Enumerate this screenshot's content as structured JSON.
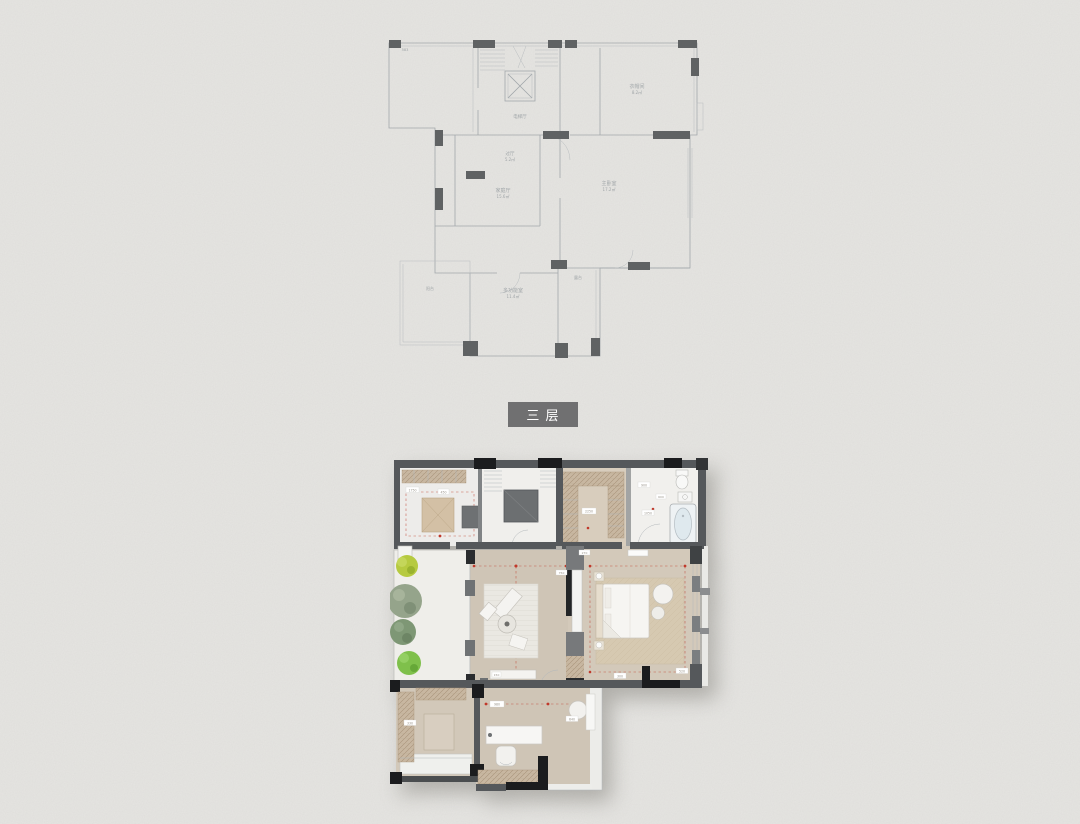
{
  "page": {
    "width": 1080,
    "height": 824,
    "background": "#e6e5e2"
  },
  "floor_badge": {
    "text": "三 层",
    "bg": "#707071",
    "color": "#ffffff"
  },
  "palette": {
    "line": "#9aa0a4",
    "wall_dark": "#4e5153",
    "wall_gray": "#55585b",
    "wall_black": "#1b1c1e",
    "floor_white": "#efeeea",
    "floor_beige": "#cfc5b6",
    "floor_beige_light": "#d8cdbd",
    "closet_tan": "#c8b7a1",
    "rug_white": "#eae8e2",
    "rug_tan": "#d6c9b1",
    "elevator_gray": "#6c6f71",
    "tree_bright": "#b6ca40",
    "tree_sage": "#95a48b",
    "tree_olive": "#7e9775",
    "tree_green": "#7fc04b",
    "accent_red": "#c0392b",
    "tub_blue": "#dfe9ee",
    "badge_bg": "#707071"
  },
  "line_plan": {
    "labels": [
      {
        "text": "583"
      },
      {
        "text": "衣帽间"
      },
      {
        "text": "8.2㎡"
      },
      {
        "text": "电梯厅"
      },
      {
        "text": "过厅"
      },
      {
        "text": "5.2㎡"
      },
      {
        "text": "家庭厅"
      },
      {
        "text": "15.6㎡"
      },
      {
        "text": "主卧室"
      },
      {
        "text": "17.2㎡"
      },
      {
        "text": "多功能室"
      },
      {
        "text": "11.4㎡"
      },
      {
        "text": "露台"
      },
      {
        "text": "阳台"
      }
    ]
  },
  "render_plan": {
    "chips": [
      {
        "text": "1750"
      },
      {
        "text": "450"
      },
      {
        "text": "2250"
      },
      {
        "text": "900"
      },
      {
        "text": "1050"
      },
      {
        "text": "600"
      },
      {
        "text": "150"
      },
      {
        "text": "750"
      },
      {
        "text": "300"
      },
      {
        "text": "520"
      },
      {
        "text": "980"
      },
      {
        "text": "640"
      },
      {
        "text": "330"
      },
      {
        "text": "270"
      }
    ]
  }
}
